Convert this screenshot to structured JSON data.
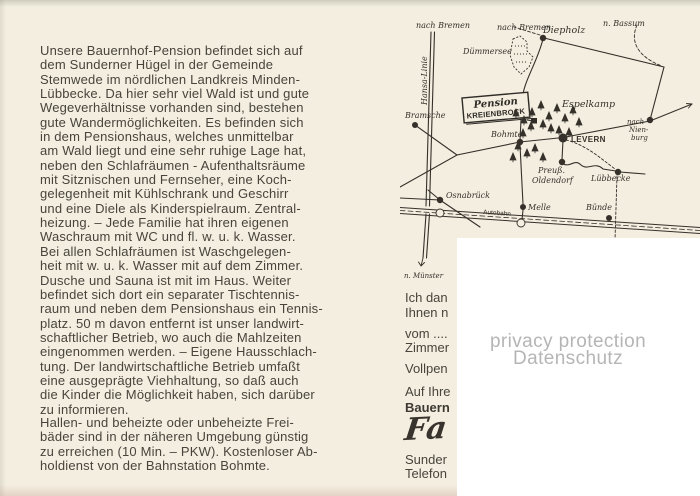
{
  "card": {
    "main_text": "Unsere Bauernhof-Pension befindet sich auf\ndem Sunderner Hügel in der Gemeinde\nStemwede im nördlichen Landkreis Minden-\nLübbecke. Da hier sehr viel Wald ist und gute\nWegeverhältnisse vorhanden sind, bestehen\ngute Wandermöglichkeiten. Es befinden sich\nin dem Pensionshaus, welches unmittelbar\nam Wald liegt und eine sehr ruhige Lage hat,\nneben den Schlafräumen - Aufenthaltsräume\nmit Sitznischen und Fernseher, eine Koch-\ngelegenheit mit Kühlschrank und Geschirr\nund eine Diele als Kinderspielraum. Zentral-\nheizung. – Jede Familie hat ihren eigenen\nWaschraum mit WC und fl. w. u. k. Wasser.\nBei allen Schlafräumen ist Waschgelegen-\nheit mit w. u. k. Wasser mit auf dem Zimmer.\nDusche und Sauna ist mit im Haus. Weiter\nbefindet sich dort ein separater Tischtennis-\nraum und neben dem Pensionshaus ein Tennis-\nplatz. 50 m davon entfernt ist unser landwirt-\nschaftlicher Betrieb, wo auch die Mahlzeiten\neingenommen werden. – Eigene Hausschlach-\ntung. Der landwirtschaftliche Betrieb umfaßt\neine ausgeprägte Viehhaltung, so daß auch\ndie Kinder die Möglichkeit haben, sich darüber\nzu informieren.",
    "secondary_text": "Hallen- und beheizte oder unbeheizte Frei-\nbäder sind in der näheren Umgebung günstig\nzu erreichen (10 Min. – PKW). Kostenloser Ab-\nholdienst von der Bahnstation Bohmte.",
    "right_column_lines": [
      {
        "text": "Ich dan",
        "top": 290
      },
      {
        "text": "Ihnen n",
        "top": 305
      },
      {
        "text": "vom ....",
        "top": 326
      },
      {
        "text": "Zimmer",
        "top": 340
      },
      {
        "text": "Vollpen",
        "top": 361
      },
      {
        "text": "Auf Ihre",
        "top": 384
      },
      {
        "text": "Bauern",
        "top": 400,
        "cls": "bold"
      },
      {
        "text": "Fa",
        "top": 411,
        "cls": "signature"
      },
      {
        "text": "Sunder",
        "top": 452
      },
      {
        "text": "Telefon",
        "top": 466
      }
    ],
    "privacy_overlay": {
      "line1": "privacy protection",
      "line2": "Datenschutz"
    }
  },
  "map": {
    "sign": {
      "script": "Pension",
      "caps": "KREIENBROCK"
    },
    "labels": [
      {
        "text": "nach Bremen",
        "x": 16,
        "y": 20
      },
      {
        "text": "Hansa-Linie",
        "x": 27,
        "y": 97,
        "rotate": -90
      },
      {
        "text": "nach Bremen",
        "x": 97,
        "y": 22
      },
      {
        "text": "Diepholz",
        "x": 143,
        "y": 25,
        "size": 9.5
      },
      {
        "text": "n. Bassum",
        "x": 203,
        "y": 18
      },
      {
        "text": "Dümmersee",
        "x": 63,
        "y": 46
      },
      {
        "text": "Bramsche",
        "x": 5,
        "y": 110
      },
      {
        "text": "Espelkamp",
        "x": 162,
        "y": 99,
        "size": 9.5
      },
      {
        "text": "Bohmte",
        "x": 91,
        "y": 129
      },
      {
        "text": "LEVERN",
        "x": 171,
        "y": 134,
        "cls": "caps"
      },
      {
        "text": "nach",
        "x": 227,
        "y": 116,
        "size": 7
      },
      {
        "text": "Nien-",
        "x": 229,
        "y": 124,
        "size": 7
      },
      {
        "text": "burg",
        "x": 231,
        "y": 132,
        "size": 7
      },
      {
        "text": "Preuß.",
        "x": 138,
        "y": 165
      },
      {
        "text": "Oldendorf",
        "x": 132,
        "y": 175
      },
      {
        "text": "Lübbecke",
        "x": 191,
        "y": 173
      },
      {
        "text": "Osnabrück",
        "x": 46,
        "y": 190
      },
      {
        "text": "Autobahn",
        "x": 83,
        "y": 206,
        "cls": "small",
        "rotate": 4
      },
      {
        "text": "Melle",
        "x": 128,
        "y": 202
      },
      {
        "text": "Bünde",
        "x": 186,
        "y": 202
      },
      {
        "text": "n. Münster",
        "x": 4,
        "y": 270,
        "size": 7
      }
    ],
    "towns": [
      {
        "name": "bramsche",
        "x": 15,
        "y": 117,
        "r": 3
      },
      {
        "name": "diepholz",
        "x": 143,
        "y": 30,
        "r": 3.2
      },
      {
        "name": "bohmte",
        "x": 120,
        "y": 134,
        "r": 3.2
      },
      {
        "name": "levern",
        "x": 163,
        "y": 130,
        "r": 4.5
      },
      {
        "name": "preuss-oldendorf",
        "x": 162,
        "y": 154,
        "r": 3.2
      },
      {
        "name": "luebbecke",
        "x": 218,
        "y": 164,
        "r": 3.2
      },
      {
        "name": "nienburg-junction",
        "x": 250,
        "y": 112,
        "r": 3.2
      },
      {
        "name": "osnabrueck",
        "x": 40,
        "y": 192,
        "r": 3.2
      },
      {
        "name": "melle",
        "x": 123,
        "y": 199,
        "r": 3
      },
      {
        "name": "buende",
        "x": 209,
        "y": 210,
        "r": 3
      }
    ],
    "trees": [
      [
        116,
        108
      ],
      [
        124,
        115
      ],
      [
        132,
        107
      ],
      [
        141,
        100
      ],
      [
        149,
        111
      ],
      [
        157,
        103
      ],
      [
        165,
        113
      ],
      [
        173,
        105
      ],
      [
        179,
        117
      ],
      [
        151,
        123
      ],
      [
        143,
        119
      ],
      [
        159,
        125
      ],
      [
        169,
        127
      ],
      [
        131,
        121
      ],
      [
        123,
        128
      ],
      [
        118,
        141
      ],
      [
        127,
        148
      ],
      [
        135,
        143
      ],
      [
        113,
        152
      ],
      [
        143,
        152
      ]
    ]
  },
  "colors": {
    "paper": "#f3eee0",
    "text_ink": "#48443c",
    "map_ink": "#35302a",
    "overlay_bg": "#ffffff",
    "privacy_text": "#b5b5b5"
  }
}
